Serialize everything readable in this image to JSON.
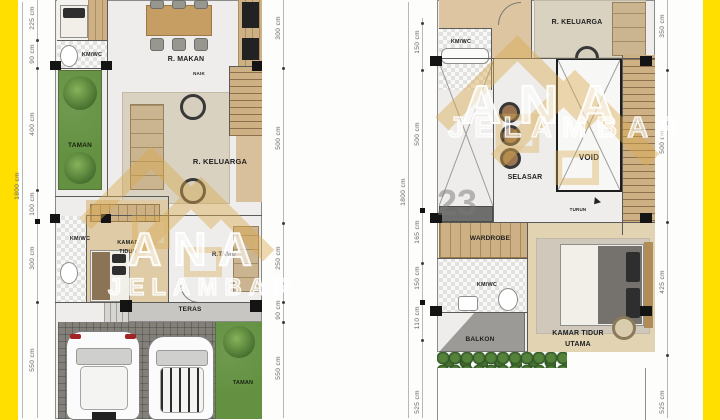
{
  "watermark": {
    "brand_top": "ANA",
    "brand_bottom": "JELAMBAR",
    "number": "23"
  },
  "palette": {
    "border_yellow": "#ffdf00",
    "wood": "#cdb184",
    "garden_green": "#639141",
    "logo_gold": "#d9a94f"
  },
  "floor1": {
    "dim_overall": "1800 cm",
    "dims_left": [
      "225 cm",
      "90 cm",
      "400 cm",
      "100 cm",
      "300 cm",
      "550 cm"
    ],
    "dims_right": [
      "300 cm",
      "500 cm",
      "250 cm",
      "90 cm",
      "550 cm"
    ],
    "rooms": {
      "kmwc_top": "KM/WC",
      "r_makan": "R. MAKAN",
      "taman_side": "TAMAN",
      "r_keluarga": "R. KELUARGA",
      "naik": "NAIK",
      "kamar_line1": "KAMAR",
      "kamar_line2": "TIDUR",
      "kmwc_bottom": "KM/WC",
      "r_tamu": "R.TAMU",
      "teras": "TERAS",
      "taman_bottom": "TAMAN"
    }
  },
  "floor2": {
    "dim_overall": "1800 cm",
    "dims_left": [
      "150 cm",
      "500 cm",
      "165 cm",
      "150 cm",
      "110 cm",
      "525 cm"
    ],
    "dims_right": [
      "350 cm",
      "500 cm",
      "425 cm",
      "525 cm"
    ],
    "rooms": {
      "kmwc_top": "KM/WC",
      "r_keluarga": "R. KELUARGA",
      "selasar": "SELASAR",
      "void": "VOID",
      "turun": "TURUN",
      "wardrobe": "WARDROBE",
      "kmwc_bottom": "KM/WC",
      "balkon": "BALKON",
      "ktu_line1": "KAMAR TIDUR",
      "ktu_line2": "UTAMA"
    }
  }
}
